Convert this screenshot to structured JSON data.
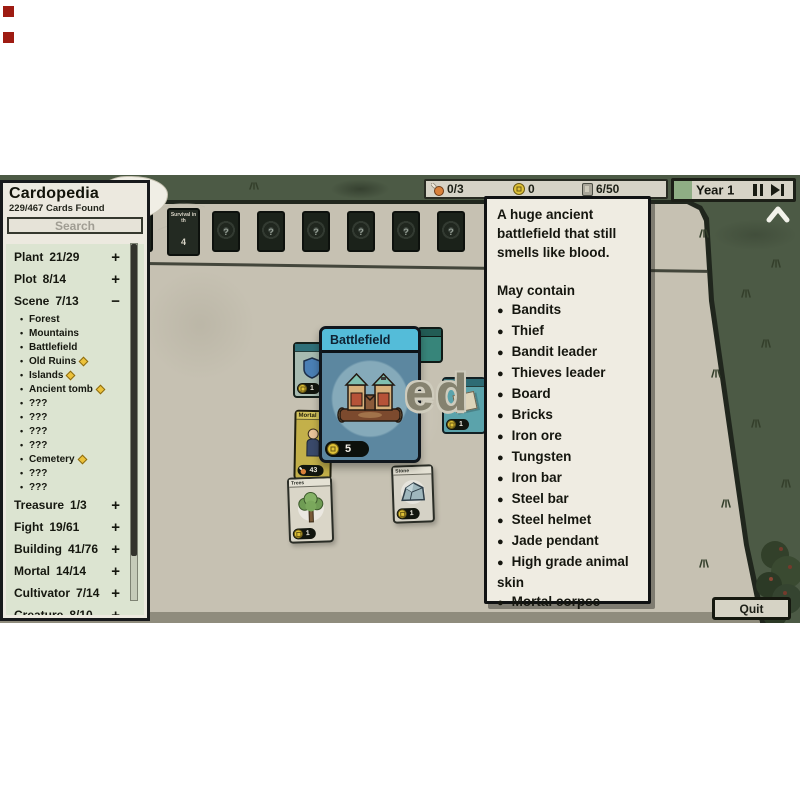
{
  "sidebar": {
    "title": "Cardopedia",
    "found": "229/467 Cards Found",
    "search_placeholder": "Search",
    "sections": [
      {
        "label": "Plant",
        "count": "21/29",
        "toggle": "+"
      },
      {
        "label": "Plot",
        "count": "8/14",
        "toggle": "+"
      },
      {
        "label": "Scene",
        "count": "7/13",
        "toggle": "−",
        "items": [
          {
            "name": "Forest",
            "rare": false
          },
          {
            "name": "Mountains",
            "rare": false
          },
          {
            "name": "Battlefield",
            "rare": false
          },
          {
            "name": "Old Ruins",
            "rare": true
          },
          {
            "name": "Islands",
            "rare": true
          },
          {
            "name": "Ancient tomb",
            "rare": true
          },
          {
            "name": "???",
            "rare": false
          },
          {
            "name": "???",
            "rare": false
          },
          {
            "name": "???",
            "rare": false
          },
          {
            "name": "???",
            "rare": false
          },
          {
            "name": "Cemetery",
            "rare": true
          },
          {
            "name": "???",
            "rare": false
          },
          {
            "name": "???",
            "rare": false
          }
        ]
      },
      {
        "label": "Treasure",
        "count": "1/3",
        "toggle": "+"
      },
      {
        "label": "Fight",
        "count": "19/61",
        "toggle": "+"
      },
      {
        "label": "Building",
        "count": "41/76",
        "toggle": "+"
      },
      {
        "label": "Mortal",
        "count": "14/14",
        "toggle": "+"
      },
      {
        "label": "Cultivator",
        "count": "7/14",
        "toggle": "+"
      },
      {
        "label": "Creature",
        "count": "8/10",
        "toggle": "+"
      }
    ]
  },
  "topbar": {
    "food": "0/3",
    "coins": "0",
    "cards": "6/50",
    "year_label": "Year 1"
  },
  "tooltip": {
    "description_lines": [
      "A huge ancient",
      "battlefield that still",
      "smells like blood."
    ],
    "may_contain": "May contain",
    "items": [
      "Bandits",
      "Thief",
      "Bandit leader",
      "Thieves leader",
      "Board",
      "Bricks",
      "Iron ore",
      "Tungsten",
      "Iron bar",
      "Steel bar",
      "Steel helmet",
      "Jade pendant",
      "High grade animal skin",
      "Mortal corpse"
    ]
  },
  "board": {
    "deck_title": "Survival in th",
    "deck_count": "4",
    "mystery_symbol": "?",
    "mystery_card_count": 7,
    "battlefield": {
      "title": "Battlefield",
      "value": "5"
    },
    "mortal": {
      "title": "Mortal",
      "value": "43"
    },
    "trees": {
      "title": "Trees",
      "value": "1"
    },
    "stone": {
      "title": "Stone",
      "value": "1"
    },
    "map_value": "1",
    "floating_text": "ed"
  },
  "buttons": {
    "quit": "Quit"
  },
  "colors": {
    "grass": "#4c5a45",
    "table": "#c6c1b2",
    "paper": "#efece2",
    "list_green": "#dce4d1",
    "coin": "#dfc238",
    "year_green": "#8fae85",
    "card_header_blue": "#54bcd9"
  }
}
